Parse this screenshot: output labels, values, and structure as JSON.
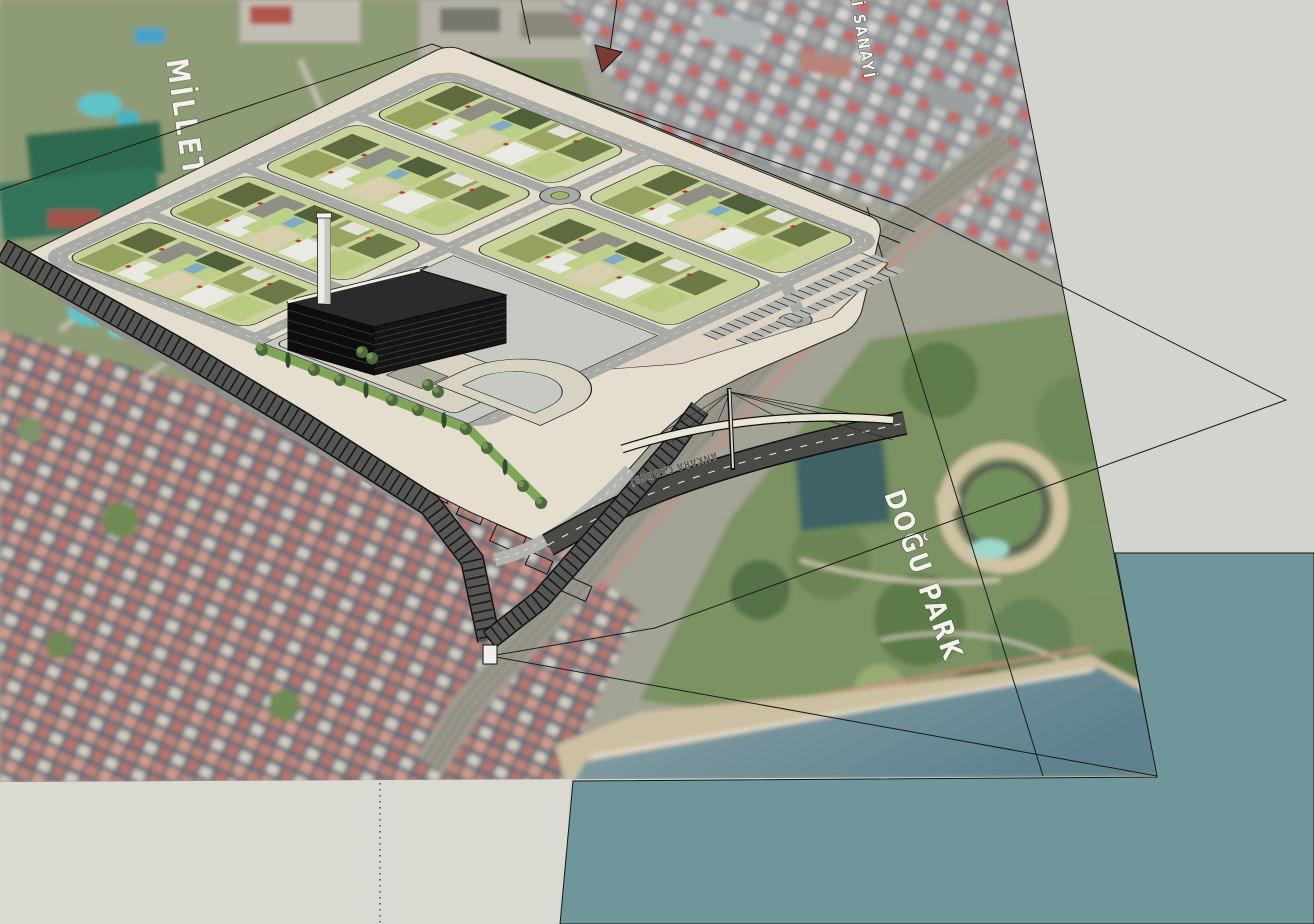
{
  "scene": {
    "title": "Masterplan 3D model over aerial basemap",
    "labels": {
      "millet_bahcesi": "MİLLET BAHÇESİ",
      "eski_sanayi": "ESKİ SANAYİ",
      "dogu_park": "DOĞU PARK",
      "road_name": "ANKARA CADDESİ"
    },
    "objects": [
      "aerial-basemap",
      "masterplan-platform",
      "parcel-blocks",
      "elevated-viaduct",
      "podium-complex",
      "black-slab-building",
      "chimney-tower",
      "cable-stayed-footbridge",
      "rail-corridor",
      "sea-plane",
      "ground-plane"
    ],
    "colors": {
      "sea_plane": "#6f969b",
      "ground_plane_left": "#dbdad2",
      "ground_plane_right": "#d2d4ce",
      "platform": "#e5ddcd",
      "parcel_green": "#c9d29a",
      "road_gray": "#a9a9a5",
      "viaduct_dark": "#565654",
      "park_green": "#7c9263",
      "city_roof": "#c08576",
      "label_text": "#f4f2ec"
    }
  }
}
